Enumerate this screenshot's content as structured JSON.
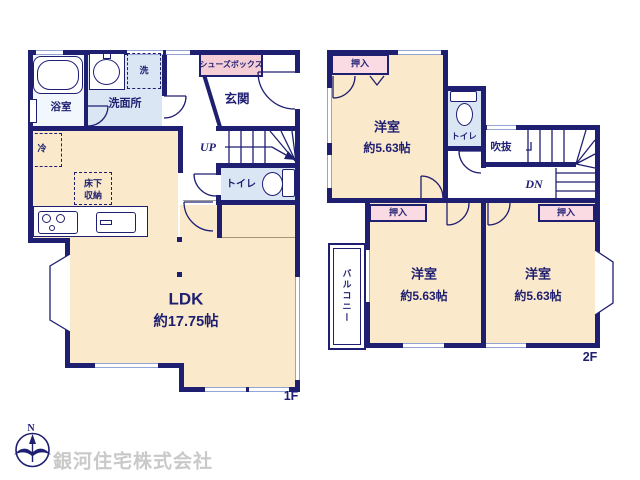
{
  "floor1": {
    "label": "1F",
    "ldk": "LDK",
    "ldk_size": "約17.75帖",
    "bath": "浴室",
    "washroom": "洗面所",
    "laundry": "洗",
    "shoebox": "シューズボックス",
    "entrance": "玄関",
    "stairs_up": "UP",
    "toilet": "トイレ",
    "fridge": "冷",
    "floor_storage_1": "床下",
    "floor_storage_2": "収納"
  },
  "floor2": {
    "label": "2F",
    "room": "洋室",
    "room_size": "約5.63帖",
    "closet": "押入",
    "toilet": "トイレ",
    "void": "吹抜",
    "stairs_down": "DN",
    "balcony": "バルコニー"
  },
  "footer": {
    "company": "銀河住宅株式会社",
    "north": "N"
  },
  "colors": {
    "wall_navy": "#1f1f72",
    "room_beige": "#faeacb",
    "wet_blue": "#dbe6f5",
    "closet_pink": "#fadbe3",
    "shoebox_pink": "#f5cdd6",
    "window_blue": "#93a4d4",
    "company_gray": "#c9c9c9"
  }
}
